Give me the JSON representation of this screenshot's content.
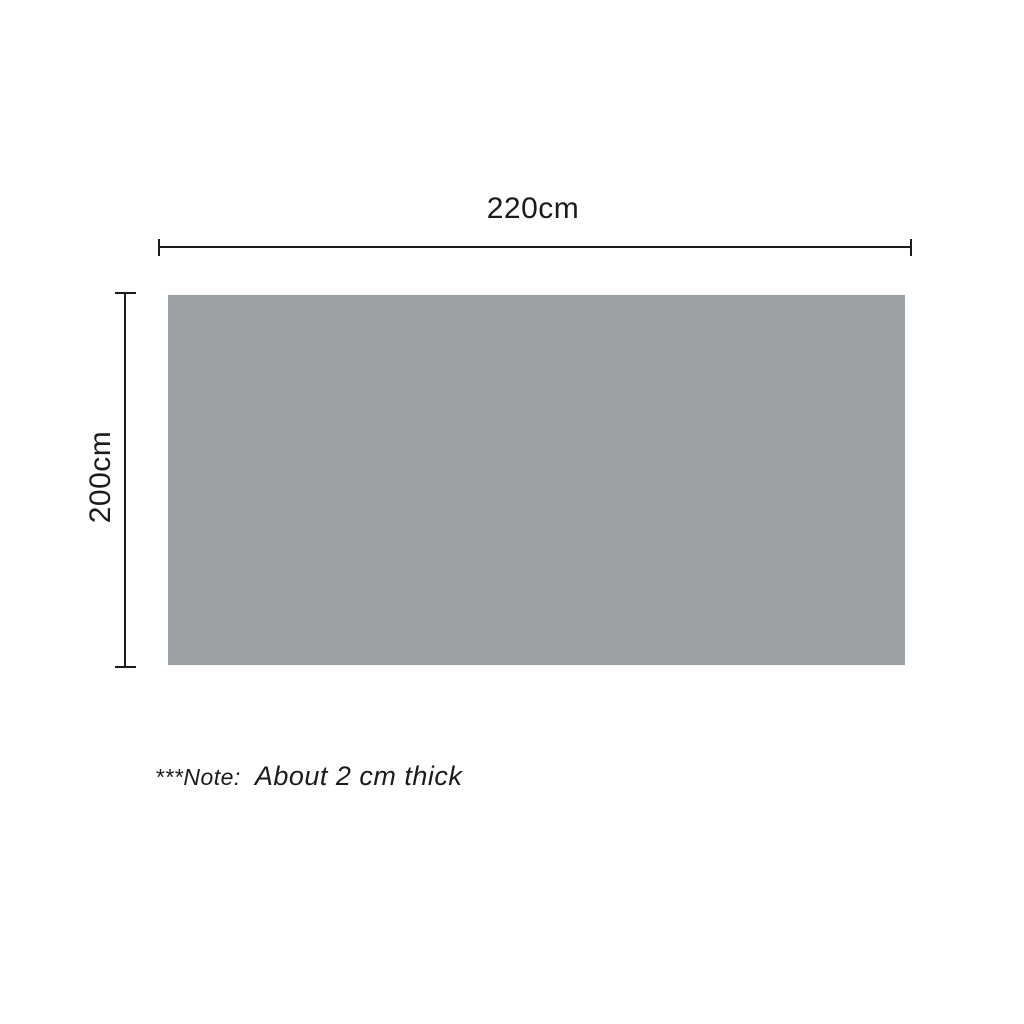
{
  "diagram": {
    "width_label": "220cm",
    "height_label": "200cm",
    "note_prefix": "***Note:",
    "note_text": "About 2 cm thick",
    "panel_color": "#9ea1a4",
    "line_color": "#1b1b1b",
    "background_color": "#ffffff"
  }
}
